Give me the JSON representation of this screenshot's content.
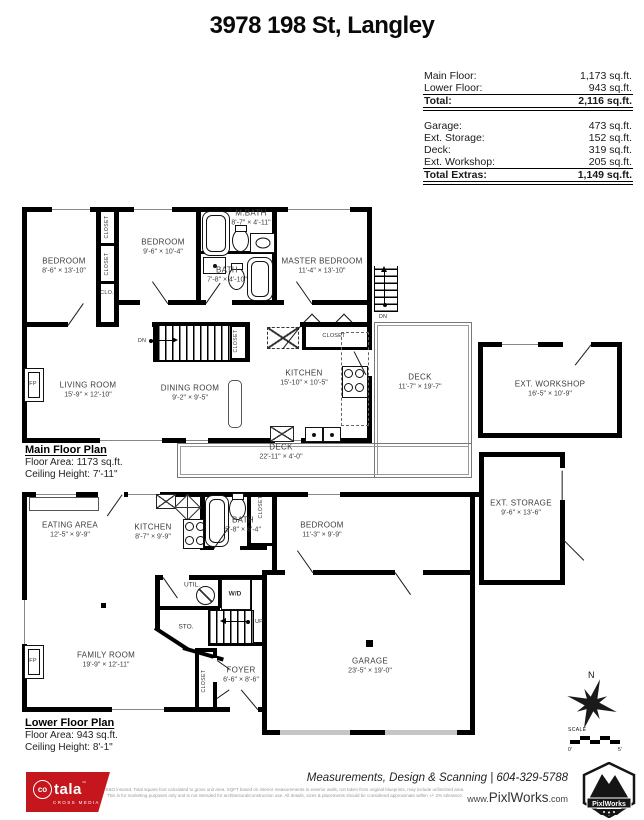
{
  "title": "3978 198 St, Langley",
  "brand": {
    "logo_red": "#c4161c"
  },
  "summary": {
    "floors": [
      {
        "label": "Main Floor:",
        "value": "1,173 sq.ft."
      },
      {
        "label": "Lower Floor:",
        "value": "943 sq.ft."
      }
    ],
    "floors_total": {
      "label": "Total:",
      "value": "2,116 sq.ft."
    },
    "extras": [
      {
        "label": "Garage:",
        "value": "473 sq.ft."
      },
      {
        "label": "Ext. Storage:",
        "value": "152 sq.ft."
      },
      {
        "label": "Deck:",
        "value": "319 sq.ft."
      },
      {
        "label": "Ext. Workshop:",
        "value": "205 sq.ft."
      }
    ],
    "extras_total": {
      "label": "Total Extras:",
      "value": "1,149 sq.ft."
    }
  },
  "main_floor": {
    "plan_label": "Main Floor Plan",
    "floor_area": "Floor Area: 1173 sq.ft.",
    "ceiling_height": "Ceiling Height: 7'-11\"",
    "rooms": {
      "bedroom1": {
        "name": "BEDROOM",
        "dims": "8'-6\" × 13'-10\""
      },
      "bedroom2": {
        "name": "BEDROOM",
        "dims": "9'-6\" × 10'-4\""
      },
      "mbath": {
        "name": "M.BATH",
        "dims": "8'-7\" × 4'-11\""
      },
      "bath": {
        "name": "BATH",
        "dims": "7'-8\" × 4'-10\""
      },
      "master": {
        "name": "MASTER BEDROOM",
        "dims": "11'-4\" × 13'-10\""
      },
      "living": {
        "name": "LIVING ROOM",
        "dims": "15'-9\" × 12'-10\""
      },
      "dining": {
        "name": "DINING ROOM",
        "dims": "9'-2\" × 9'-5\""
      },
      "kitchen": {
        "name": "KITCHEN",
        "dims": "15'-10\" × 10'-5\""
      },
      "deck_side": {
        "name": "DECK",
        "dims": "11'-7\" × 19'-7\""
      },
      "deck_bottom": {
        "name": "DECK",
        "dims": "22'-11\" × 4'-0\""
      }
    },
    "labels": {
      "closet_top": "CLOSET",
      "closet_mid": "CLOSET",
      "clo": "CLO.",
      "closet_stairs": "CLOSET",
      "closet_master": "CLOSET",
      "dn_inner": "DN",
      "dn_outer": "DN",
      "fp": "FP"
    }
  },
  "exterior": {
    "workshop": {
      "name": "EXT. WORKSHOP",
      "dims": "16'-5\" × 10'-9\""
    },
    "storage": {
      "name": "EXT. STORAGE",
      "dims": "9'-6\" × 13'-6\""
    }
  },
  "lower_floor": {
    "plan_label": "Lower Floor Plan",
    "floor_area": "Floor Area: 943 sq.ft.",
    "ceiling_height": "Ceiling Height: 8'-1\"",
    "rooms": {
      "eating": {
        "name": "EATING AREA",
        "dims": "12'-5\" × 9'-9\""
      },
      "kitchen": {
        "name": "KITCHEN",
        "dims": "8'-7\" × 9'-9\""
      },
      "bath": {
        "name": "BATH",
        "dims": "5'-8\" × 6'-4\""
      },
      "bedroom": {
        "name": "BEDROOM",
        "dims": "11'-3\" × 9'-9\""
      },
      "family": {
        "name": "FAMILY ROOM",
        "dims": "19'-9\" × 12'-11\""
      },
      "foyer": {
        "name": "FOYER",
        "dims": "6'-6\" × 8'-6\""
      },
      "garage": {
        "name": "GARAGE",
        "dims": "23'-5\" × 19'-0\""
      }
    },
    "labels": {
      "util": "UTIL.",
      "wd": "W/D",
      "sto": "STO.",
      "up": "UP",
      "closet_bath": "CLOSET",
      "closet_foyer": "CLOSET",
      "fp": "FP"
    }
  },
  "compass": {
    "north": "N"
  },
  "scale_bar": {
    "label": "SCALE",
    "start": "0'",
    "end": "5'"
  },
  "footer": {
    "logo_co": "co",
    "logo_tala": "tala",
    "logo_tm": "™",
    "logo_sub": "CROSS MEDIA",
    "disclaimer1": "E&O insured. Total square foot calculated to gross unit area. SQFT based on interior measurements to exterior walls, not taken from original blueprints, may include unfinished area.",
    "disclaimer2": "This is for marketing purposes only and is not intended for architectural/construction use. All details, sizes & placements should be considered approximate within +/- 2% tolerance.",
    "tagline": "Measurements, Design & Scanning | 604-329-5788",
    "website_prefix": "www.",
    "website_name": "PixlWorks",
    "website_suffix": ".com",
    "badge": "PixlWorks"
  }
}
